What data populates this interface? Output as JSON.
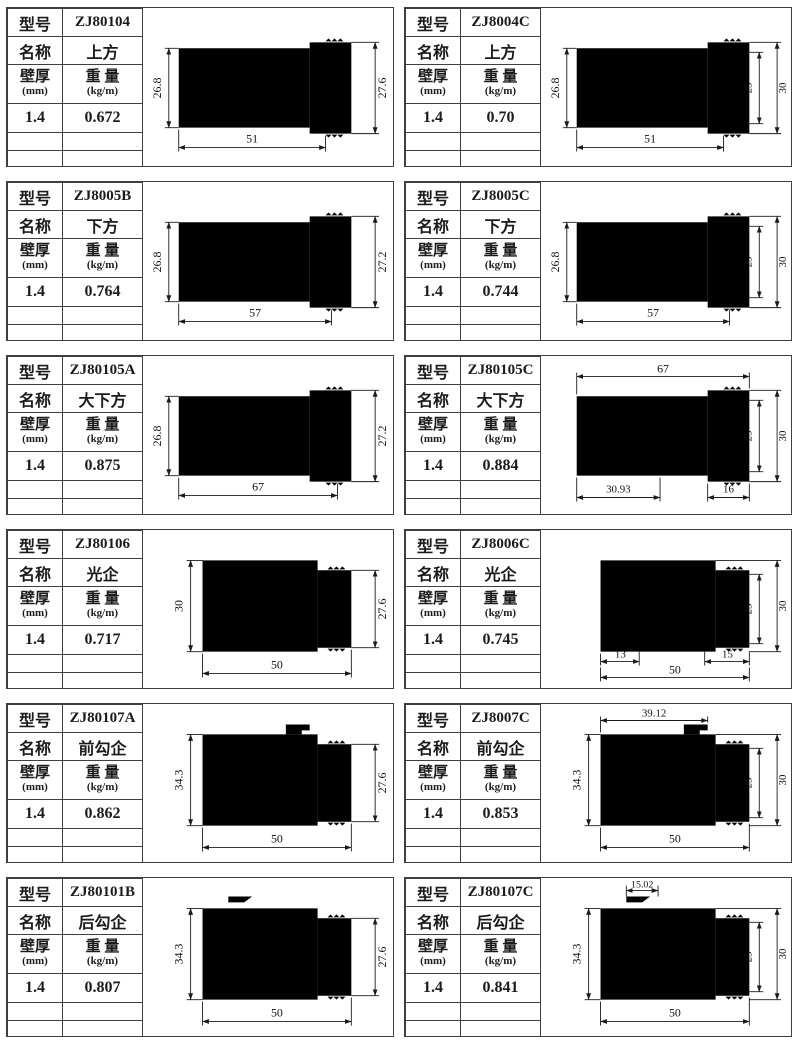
{
  "labels": {
    "model": "型号",
    "name": "名称",
    "thickness_line1": "壁厚",
    "thickness_line2": "(mm)",
    "weight_line1": "重 量",
    "weight_line2": "(kg/m)"
  },
  "colors": {
    "ink": "#1b1b1b",
    "border": "#3f3f3f",
    "background": "#ffffff"
  },
  "cells": [
    {
      "model": "ZJ80104",
      "name": "上方",
      "thickness": "1.4",
      "weight": "0.672",
      "dims": {
        "left": "26.8",
        "right": "27.6",
        "bottom": "51"
      }
    },
    {
      "model": "ZJ8004C",
      "name": "上方",
      "thickness": "1.4",
      "weight": "0.70",
      "dims": {
        "left": "26.8",
        "right_inner": "25",
        "right_outer": "30",
        "bottom": "51"
      }
    },
    {
      "model": "ZJ8005B",
      "name": "下方",
      "thickness": "1.4",
      "weight": "0.764",
      "dims": {
        "left": "26.8",
        "right": "27.2",
        "bottom": "57"
      }
    },
    {
      "model": "ZJ8005C",
      "name": "下方",
      "thickness": "1.4",
      "weight": "0.744",
      "dims": {
        "left": "26.8",
        "right_inner": "25",
        "right_outer": "30",
        "bottom": "57"
      }
    },
    {
      "model": "ZJ80105A",
      "name": "大下方",
      "thickness": "1.4",
      "weight": "0.875",
      "dims": {
        "left": "26.8",
        "right": "27.2",
        "bottom": "67"
      }
    },
    {
      "model": "ZJ80105C",
      "name": "大下方",
      "thickness": "1.4",
      "weight": "0.884",
      "dims": {
        "top": "67",
        "right_inner": "25",
        "right_outer": "30",
        "bottom_left": "30.93",
        "bottom_right": "16"
      }
    },
    {
      "model": "ZJ80106",
      "name": "光企",
      "thickness": "1.4",
      "weight": "0.717",
      "dims": {
        "left": "30",
        "right": "27.6",
        "bottom": "50"
      }
    },
    {
      "model": "ZJ8006C",
      "name": "光企",
      "thickness": "1.4",
      "weight": "0.745",
      "dims": {
        "right_inner": "25",
        "right_outer": "30",
        "bottom_left": "13",
        "bottom": "50",
        "bottom_right": "15"
      }
    },
    {
      "model": "ZJ80107A",
      "name": "前勾企",
      "thickness": "1.4",
      "weight": "0.862",
      "dims": {
        "left": "34.3",
        "right": "27.6",
        "bottom": "50"
      }
    },
    {
      "model": "ZJ8007C",
      "name": "前勾企",
      "thickness": "1.4",
      "weight": "0.853",
      "dims": {
        "top": "39.12",
        "left": "34.3",
        "right_inner": "25",
        "right_outer": "30",
        "bottom": "50"
      }
    },
    {
      "model": "ZJ80101B",
      "name": "后勾企",
      "thickness": "1.4",
      "weight": "0.807",
      "dims": {
        "left": "34.3",
        "right": "27.6",
        "bottom": "50"
      }
    },
    {
      "model": "ZJ80107C",
      "name": "后勾企",
      "thickness": "1.4",
      "weight": "0.841",
      "dims": {
        "top": "15.02",
        "left": "34.3",
        "right_inner": "25",
        "right_outer": "30",
        "bottom": "50"
      }
    }
  ]
}
